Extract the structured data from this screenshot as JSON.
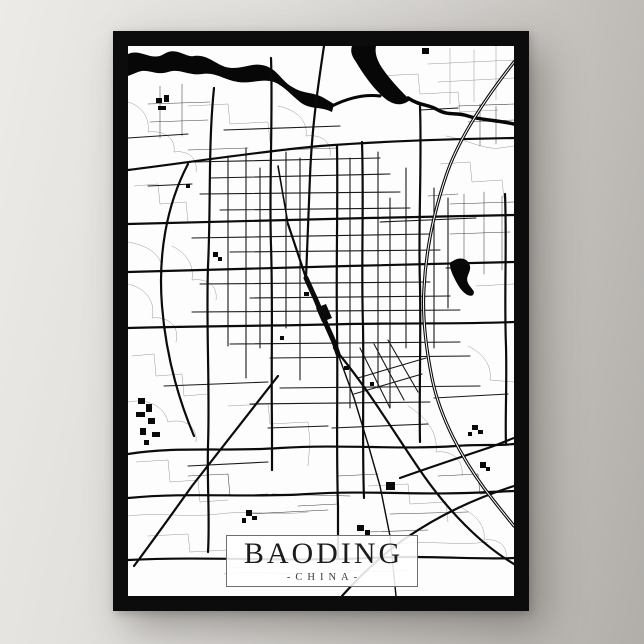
{
  "poster": {
    "title": "BAODING",
    "subtitle": "-CHINA-",
    "colors": {
      "frame": "#0c0c0c",
      "map_background": "#fdfdfd",
      "wall_light": "#edebe8",
      "wall_dark": "#b1aeaa",
      "title_text": "#1c1c1c",
      "subtitle_text": "#3c3c3c",
      "plate_border": "#6f6f6f",
      "road_major": "#0b0b0b",
      "road_medium": "#191919",
      "road_thin": "#404040",
      "road_faint": "#999999",
      "water": "#070707"
    }
  },
  "map": {
    "canvas": {
      "width": 386,
      "height": 550
    },
    "layers": [
      {
        "name": "roads-faint",
        "color": "#999999",
        "w": 0.5,
        "fill": false,
        "paths": [
          "M0,56 C14,60 22,72 20,86 C36,84 48,92 46,106 C60,104 70,112 68,126",
          "M6,140 L30,138 L32,158 L58,156 L60,176",
          "M0,238 C18,242 28,256 24,272 C40,270 52,280 48,296",
          "M4,310 L26,308 L28,330 L54,328 L56,350 L80,348",
          "M0,356 C20,352 36,360 40,376 C56,372 70,380 68,396",
          "M8,416 L40,414 L42,436 L70,434 L72,456 L100,454",
          "M0,470 C30,466 60,472 90,468 C120,464 150,470 180,466",
          "M20,490 L60,488 L62,506 L100,504 L102,522 L140,520",
          "M96,528 C130,524 160,530 190,526 C220,522 250,528 280,524",
          "M60,60 L100,58 L102,78 L140,76 L142,96",
          "M150,60 C170,64 180,76 178,90 C194,88 204,96 202,110",
          "M250,30 L290,28 L292,48 L330,46 L332,66 L370,64",
          "M300,18 L386,14",
          "M310,36 L386,32",
          "M322,2 L322,58",
          "M346,4 L346,56",
          "M368,0 L368,54",
          "M318,90 C340,94 356,104 372,102 L386,100",
          "M312,118 L342,116 L344,136 L374,134 L376,152",
          "M280,360 C300,372 310,388 308,406 C324,404 336,414 334,430",
          "M240,440 L280,438 L282,458 L318,456 L320,476",
          "M180,500 C210,496 240,502 270,498 C300,494 330,500 360,496",
          "M330,460 C348,468 358,480 356,494 C370,492 380,500 378,512",
          "M100,360 L140,358 L142,378 L180,376 L182,396 L180,420",
          "M0,196 C24,200 36,212 34,228",
          "M348,240 L386,238",
          "M340,300 C356,308 364,320 362,334 L386,336",
          "M44,200 C60,208 66,220 64,234 C80,232 90,240 88,254"
        ]
      },
      {
        "name": "roads-thin",
        "color": "#404040",
        "w": 0.55,
        "fill": false,
        "paths": [
          "M20,58 L82,56",
          "M22,76 L80,74",
          "M32,40 L32,92",
          "M54,38 L54,90",
          "M322,158 L386,156",
          "M322,188 L382,186",
          "M336,148 L336,230",
          "M356,146 L356,228",
          "M374,150 L374,224",
          "M300,150 L330,148",
          "M120,468 L200,464",
          "M144,448 L222,450",
          "M262,468 L340,466",
          "M240,486 L300,484",
          "M150,104 L210,102",
          "M60,104 L120,102",
          "M330,60 L386,58",
          "M340,76 L386,74",
          "M352,58 L352,100",
          "M368,60 L368,98",
          "M310,430 L350,428 L352,448 L380,446",
          "M60,430 L100,428 L102,450 L140,448",
          "M210,430 L250,428",
          "M170,460 L210,458"
        ]
      },
      {
        "name": "roads-medium",
        "color": "#191919",
        "w": 1.1,
        "fill": false,
        "paths": [
          "M64,116 L252,112",
          "M82,132 L262,128",
          "M72,148 L272,146",
          "M92,164 L282,162",
          "M64,192 L302,188",
          "M102,206 L312,204",
          "M72,238 L302,236",
          "M122,252 L322,250",
          "M64,266 L332,264",
          "M102,298 L332,296",
          "M142,312 L342,310",
          "M152,342 L352,340",
          "M122,358 L302,356",
          "M100,112 L100,300",
          "M118,102 L118,332",
          "M132,122 L132,302",
          "M158,106 L158,282",
          "M172,112 L172,334",
          "M222,112 L222,362",
          "M250,106 L250,342",
          "M262,152 L262,362",
          "M278,122 L278,302",
          "M306,142 L306,302",
          "M320,152 L320,262",
          "M232,302 L262,362",
          "M246,298 L276,354",
          "M260,294 L290,346",
          "M230,332 L298,312",
          "M226,348 L294,328",
          "M292,64 L330,62",
          "M60,420 L140,416",
          "M252,176 L348,172",
          "M96,84 L212,80",
          "M36,340 L140,336",
          "M204,382 L300,378",
          "M140,382 L200,380",
          "M306,352 L380,348",
          "M20,140 L64,138",
          "M0,92 L60,88"
        ]
      },
      {
        "name": "water",
        "color": "#070707",
        "w": 0,
        "fill": true,
        "paths": [
          "M0,8 C12,2 24,16 36,8 C48,0 58,12 66,10 C82,8 90,22 104,22 C118,22 126,16 138,20 C150,24 154,36 166,42 C176,48 186,46 196,52 L206,58 L204,66 C192,60 182,64 172,56 C162,48 156,40 146,36 C134,32 124,38 110,36 C96,34 88,26 74,28 C60,30 52,22 40,26 C28,30 20,22 10,26 L0,30 Z",
          "M224,0 L248,0 C246,10 252,20 260,30 C268,40 276,48 282,54 C272,62 262,58 252,48 C242,38 234,26 228,16 C224,10 222,6 224,0 Z",
          "M325,215 C332,210 341,213 342,220 C343,227 337,230 340,237 C343,243 348,245 345,249 C341,252 334,246 330,239 C326,232 322,224 322,219 C322,216 323,216 325,215 Z",
          "M294,2 h7 v6 h-7 Z"
        ]
      },
      {
        "name": "water-strokes",
        "color": "#070707",
        "w": 3,
        "fill": false,
        "paths": [
          {
            "d": "M204,60 C220,52 236,48 252,50",
            "w": 3
          },
          {
            "d": "M280,52 C292,60 300,58 310,64 C320,70 330,66 340,70 C352,74 368,74 386,78",
            "w": 3.5
          },
          {
            "d": "M318,222 L327,222",
            "w": 1
          }
        ]
      },
      {
        "name": "blocks",
        "color": "#0a0a0a",
        "w": 0,
        "fill": true,
        "paths": [
          "M28,52h6v5h-6Z",
          "M36,49h5v7h-5Z",
          "M30,60h8v4h-8Z",
          "M85,206h5v5h-5Z",
          "M90,211h4v4h-4Z",
          "M10,352h7v6h-7Z",
          "M18,358h6v8h-6Z",
          "M8,366h9v5h-9Z",
          "M20,372h7v6h-7Z",
          "M12,382h6v7h-6Z",
          "M24,386h8v5h-8Z",
          "M16,394h5v5h-5Z",
          "M118,464h6v6h-6Z",
          "M124,470h5v4h-5Z",
          "M114,472h4v5h-4Z",
          "M229,479h7v6h-7Z",
          "M237,484h5v5h-5Z",
          "M258,436h9v8h-9Z",
          "M344,379h6v5h-6Z",
          "M350,384h5v4h-5Z",
          "M340,386h4v4h-4Z",
          "M352,416h6v6h-6Z",
          "M358,421h4v4h-4Z",
          "M176,246h5v4h-5Z",
          "M152,290h4v4h-4Z",
          "M216,320h5v4h-5Z",
          "M242,336h4v4h-4Z",
          "M58,138h4v4h-4Z",
          "M188,262 l10,-4 l6,14 l-10,4 Z"
        ]
      },
      {
        "name": "roads-major",
        "color": "#0b0b0b",
        "w": 2.2,
        "fill": false,
        "paths": [
          "M0,124 C64,116 128,106 192,100 C256,95 322,93 386,92",
          "M0,178 C80,176 160,174 240,172 C300,171 350,170 386,169",
          "M0,226 C70,224 150,222 220,220 C290,218 340,217 386,216",
          "M0,282 C70,280 150,280 220,278 C290,277 340,278 386,276",
          "M0,408 C48,400 96,406 152,402 C216,398 272,404 328,400 C352,398 372,400 386,398",
          "M0,452 C60,446 120,452 180,448 C240,444 300,450 360,446 L386,445",
          "M0,514 C80,510 160,516 240,512 C300,509 350,514 386,512",
          "M86,42 C80,100 83,160 80,220 C78,280 82,340 80,400 C79,440 82,472 80,506",
          "M143,12 C145,70 141,140 143,200 C145,260 143,320 144,380 L144,424",
          "M196,0 C190,40 184,80 182,130 C180,180 179,206 178,232",
          "M209,100 C210,160 208,220 209,280 C210,340 208,400 210,460 L210,512",
          "M234,96 C236,160 233,220 235,280 C236,340 234,400 236,452",
          "M292,60 C294,120 290,180 292,240 C293,300 291,350 292,396",
          "M377,148 C379,200 376,250 378,300 C379,340 377,374 378,398",
          "M60,118 C38,160 30,210 34,260 C38,310 50,352 66,390",
          "M150,330 C120,368 92,404 64,440 C44,468 24,496 6,520",
          "M206,302 C240,342 268,390 296,430 C320,464 352,498 386,518",
          "M386,440 C348,452 310,470 278,492 C252,510 230,532 214,550",
          "M272,432 C300,422 330,412 360,402 C372,398 380,394 386,392"
        ]
      },
      {
        "name": "railway",
        "color": "#0a0a0a",
        "w": 2,
        "fill": false,
        "paths": [
          {
            "d": "M178,232 L188,254 L198,278 L206,296 L210,308",
            "w": 5
          },
          {
            "d": "M210,308 L226,352 L240,398 L252,440 L262,490 L268,550",
            "w": 1.4
          },
          {
            "d": "M160,178 L178,232",
            "w": 2.2
          },
          {
            "d": "M150,120 L160,178",
            "w": 1.6
          }
        ]
      },
      {
        "name": "highway-casing",
        "color": "#0b0b0b",
        "w": 3.2,
        "fill": false,
        "paths": [
          "M386,16 C356,54 330,94 318,130 C306,166 298,204 296,242 C294,272 298,302 304,332 C312,372 334,412 356,442 C368,458 378,470 386,480"
        ]
      },
      {
        "name": "highway-inner",
        "color": "#ffffff",
        "w": 1,
        "fill": false,
        "paths": [
          "M386,16 C356,54 330,94 318,130 C306,166 298,204 296,242 C294,272 298,302 304,332 C312,372 334,412 356,442 C368,458 378,470 386,480"
        ]
      }
    ]
  }
}
